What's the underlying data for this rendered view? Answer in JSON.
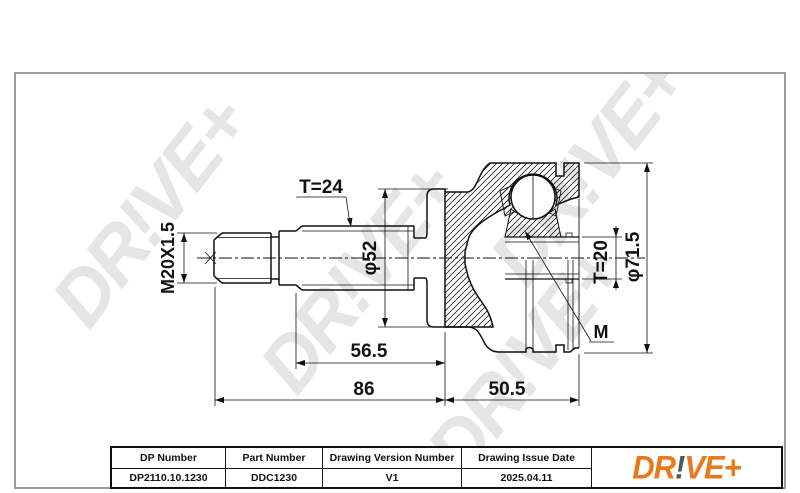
{
  "drawing": {
    "labels": {
      "thread_spec": "M20X1.5",
      "outer_spline_teeth": "T=24",
      "body_diameter": "φ52",
      "inner_spline_teeth": "T=20",
      "housing_diameter": "φ71.5",
      "module_label": "M",
      "length_inner": "56.5",
      "length_overall_shaft": "86",
      "length_housing": "50.5"
    }
  },
  "watermark": {
    "text": "DR!VE+",
    "color": "#e5e5e5"
  },
  "footer_table": {
    "headers": [
      "DP Number",
      "Part Number",
      "Drawing Version Number",
      "Drawing Issue Date"
    ],
    "values": [
      "DP2110.10.1230",
      "DDC1230",
      "V1",
      "2025.04.11"
    ]
  },
  "logo": {
    "prefix": "DR",
    "exclamation": "!",
    "suffix": "VE+",
    "orange": "#e87a1e",
    "dark_gray": "#55565a"
  }
}
